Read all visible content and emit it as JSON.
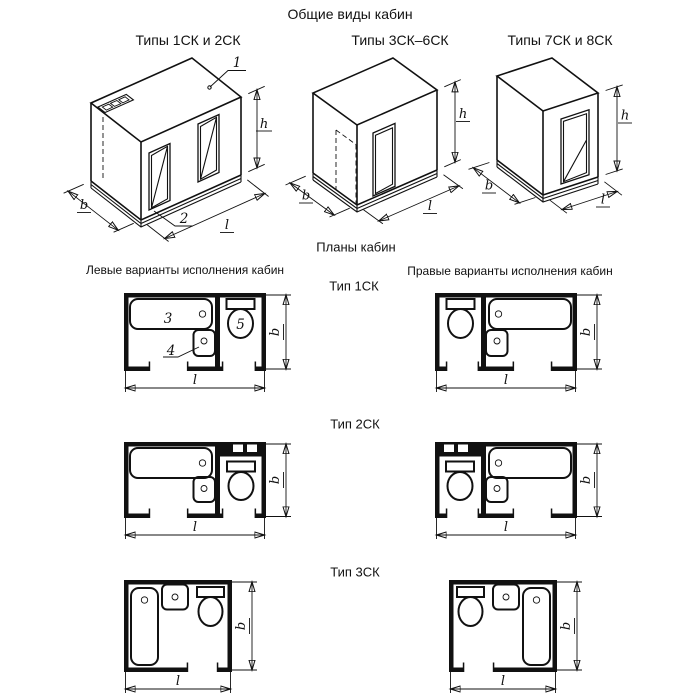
{
  "page": {
    "background": "#ffffff",
    "line_color": "#111111"
  },
  "header": {
    "title": "Общие виды кабин"
  },
  "iso_views": {
    "items": [
      {
        "label": "Типы 1СК и 2СК"
      },
      {
        "label": "Типы 3СК–6СК"
      },
      {
        "label": "Типы 7СК и 8СК"
      }
    ]
  },
  "plans": {
    "title": "Планы кабин",
    "left_header": "Левые варианты исполнения кабин",
    "right_header": "Правые варианты исполнения кабин",
    "types": [
      {
        "label": "Тип 1СК"
      },
      {
        "label": "Тип 2СК"
      },
      {
        "label": "Тип 3СК"
      }
    ]
  },
  "dims": {
    "width": "b",
    "length": "l",
    "height": "h"
  },
  "callouts": {
    "roof": "1",
    "base": "2",
    "bath": "3",
    "washbasin": "4",
    "toilet": "5"
  }
}
